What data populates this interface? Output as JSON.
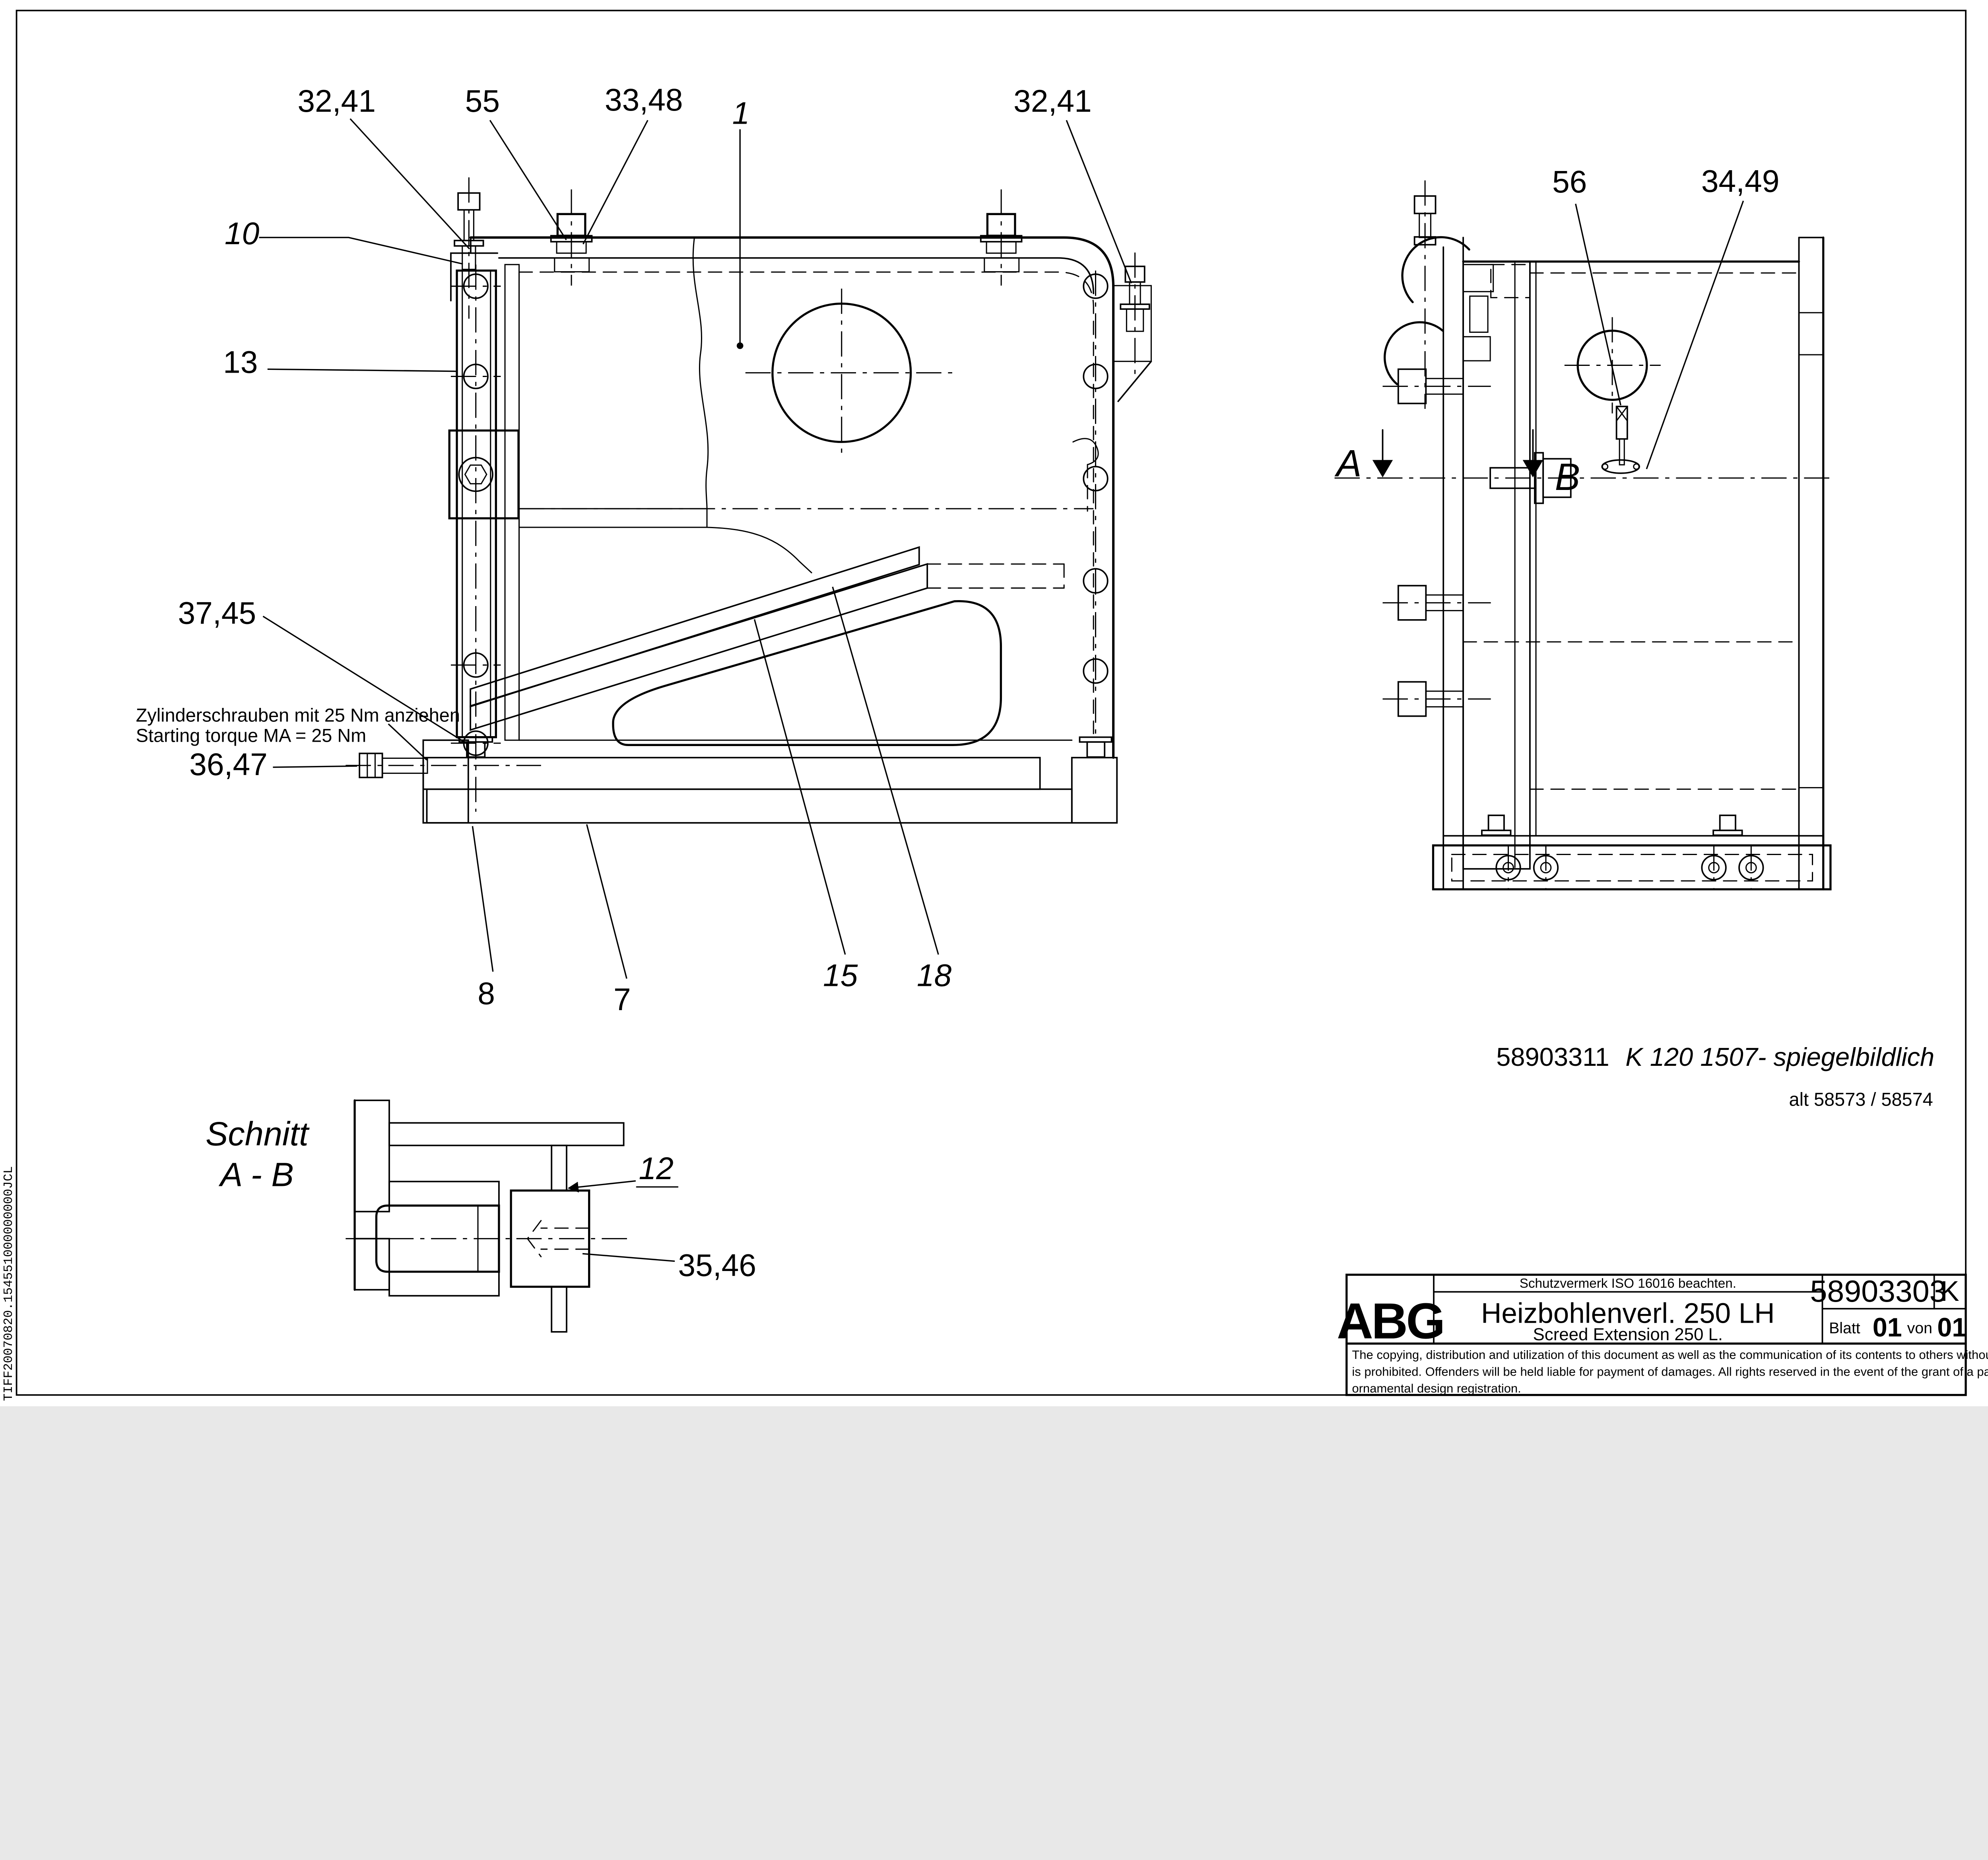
{
  "sheet": {
    "film_code": "TIFF20070820.154551000000000JCL"
  },
  "labels": {
    "pos32_41_left": "32,41",
    "pos55": "55",
    "pos33_48": "33,48",
    "pos1": "1",
    "pos32_41_right": "32,41",
    "pos56": "56",
    "pos34_49": "34,49",
    "pos10": "10",
    "pos13": "13",
    "pos37_45": "37,45",
    "pos36_47": "36,47",
    "pos8": "8",
    "pos7": "7",
    "pos15": "15",
    "pos18": "18",
    "pos12": "12",
    "pos35_46": "35,46"
  },
  "notes": {
    "torque_de": "Zylinderschrauben mit 25 Nm anziehen",
    "torque_en": "Starting torque MA = 25 Nm",
    "ref_number": "58903311",
    "ref_variant": "K 120 1507- spiegelbildlich",
    "alt_ref": "alt 58573 / 58574",
    "section_label_line1": "Schnitt",
    "section_label_line2": "A - B",
    "cut_arrow_a": "A",
    "cut_arrow_b": "B"
  },
  "title_block": {
    "manufacturer": "ABG",
    "protection_note": "Schutzvermerk ISO 16016 beachten.",
    "title_de": "Heizbohlenverl. 250 LH",
    "title_en": "Screed Extension 250 L.",
    "drawing_number": "58903303",
    "revision": "K",
    "sheet_label": "Blatt",
    "sheet_number": "01",
    "sheet_of_label": "von",
    "sheet_total": "01",
    "legal_line1": "The copying, distribution and utilization of this document as well as the communication of its contents to others without expressed authorization",
    "legal_line2": "is prohibited. Offenders will be held liable for payment of damages. All rights reserved in the event of the grant of a patent, utility model or",
    "legal_line3": "ornamental design registration."
  }
}
